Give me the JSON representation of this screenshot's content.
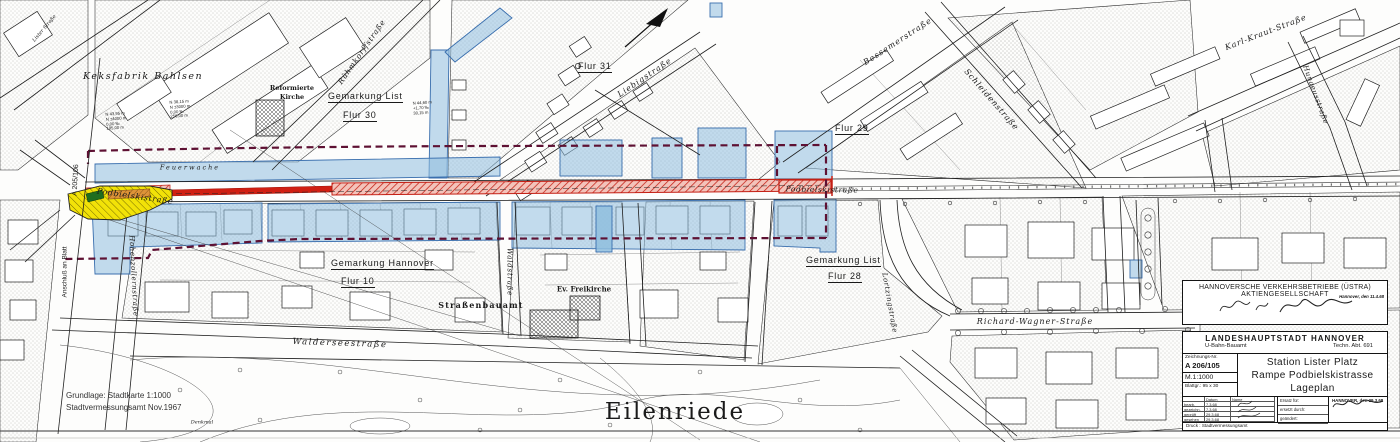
{
  "map": {
    "labels": {
      "keksfabrik": "Keksfabrik Bahlsen",
      "reformierte_1": "Reformierte",
      "reformierte_2": "Kirche",
      "gemarkung_list_nord": "Gemarkung List",
      "flur_30": "Flur 30",
      "flur_31": "Flur 31",
      "flur_29": "Flur 29",
      "gemarkung_list_sued": "Gemarkung List",
      "flur_28": "Flur 28",
      "gemarkung_hannover": "Gemarkung Hannover",
      "flur_10": "Flur 10",
      "ruehmkorffstrasse": "Rühmkorffstraße",
      "liebigstrasse": "Liebigstraße",
      "bessemerstrasse": "Bessemerstraße",
      "schleidenstrasse": "Schleidenstraße",
      "karl_kraut_strasse": "Karl-Kraut-Straße",
      "hunaeusstrasse": "Hunaeusstraße",
      "podbielskistrasse_west": "Podbielskistraße",
      "podbielskistrasse_ost": "Podbielskistraße",
      "feuerwache": "Feuerwache",
      "strassenbauamt": "Straßenbauamt",
      "ev_freikirche": "Ev. Freikirche",
      "walderseestrasse": "Walderseestraße",
      "waldstrasse": "Waldstraße",
      "hohenzollernstrasse": "Hohenzollernstraße",
      "lortzingstrasse": "Lortzingstraße",
      "richard_wagner_strasse": "Richard-Wagner-Straße",
      "lister_strasse": "Lister Straße",
      "eilenriede": "Eilenriede",
      "denkmal": "Denkmal"
    },
    "annotations": {
      "a1": [
        "N 43,95 m",
        "N ±4000 m",
        "0,00 ‰",
        "195,00 m"
      ],
      "a2": [
        "N 38,15 m",
        "N ±3000 m",
        "0,00 ‰",
        "256,00 m"
      ],
      "a3": [
        "N 44,60 m",
        "+1,70 ‰",
        "30,15 m"
      ]
    },
    "match_line": {
      "anschluss": "Anschluß an Blatt",
      "sheet_ref": "A 205/106"
    },
    "margin": {
      "grundlage": "Grundlage: Stadtkarte 1:1000",
      "vermessung": "Stadtvermessungsamt Nov.1967"
    }
  },
  "ustra_block": {
    "line1": "HANNOVERSCHE VERKEHRSBETRIEBE (ÜSTRA)",
    "line2": "AKTIENGESELLSCHAFT",
    "date_stamp": "Hannover, den 11.4.68"
  },
  "title_block": {
    "authority": "LANDESHAUPTSTADT HANNOVER",
    "department": "U-Bahn-Bauamt",
    "dept_abt": "Techn. Abt. 691",
    "drawing_no_label": "Zeichnungs-Nr.",
    "drawing_no": "A 206/105",
    "scale": "M.1:1000",
    "sheet_size": "Blattgr.: 95 x 30",
    "title1": "Station Lister Platz",
    "title2": "Rampe Podbielskistrasse",
    "title3": "Lageplan",
    "table": {
      "col_datum": "Datum",
      "col_name": "Name",
      "rows": [
        {
          "label": "bearb.",
          "date": "7.3.68"
        },
        {
          "label": "gezeichn.",
          "date": "7.3.68"
        },
        {
          "label": "geprüft",
          "date": "29.3.68"
        },
        {
          "label": "gesehen",
          "date": "29.3.68"
        }
      ],
      "ersatz": "Ersatz für:",
      "ersetzt": "ersetzt durch:",
      "geaendert": "geändert:",
      "place_date": "HANNOVER, den 29.3.68",
      "druck": "Druck : Stadtvermessungsamt"
    }
  },
  "colors": {
    "ramp_red": "#c81e12",
    "overlay_blue": "#8fbede",
    "station_yellow": "#f2e208",
    "boundary_maroon": "#5e1133"
  }
}
